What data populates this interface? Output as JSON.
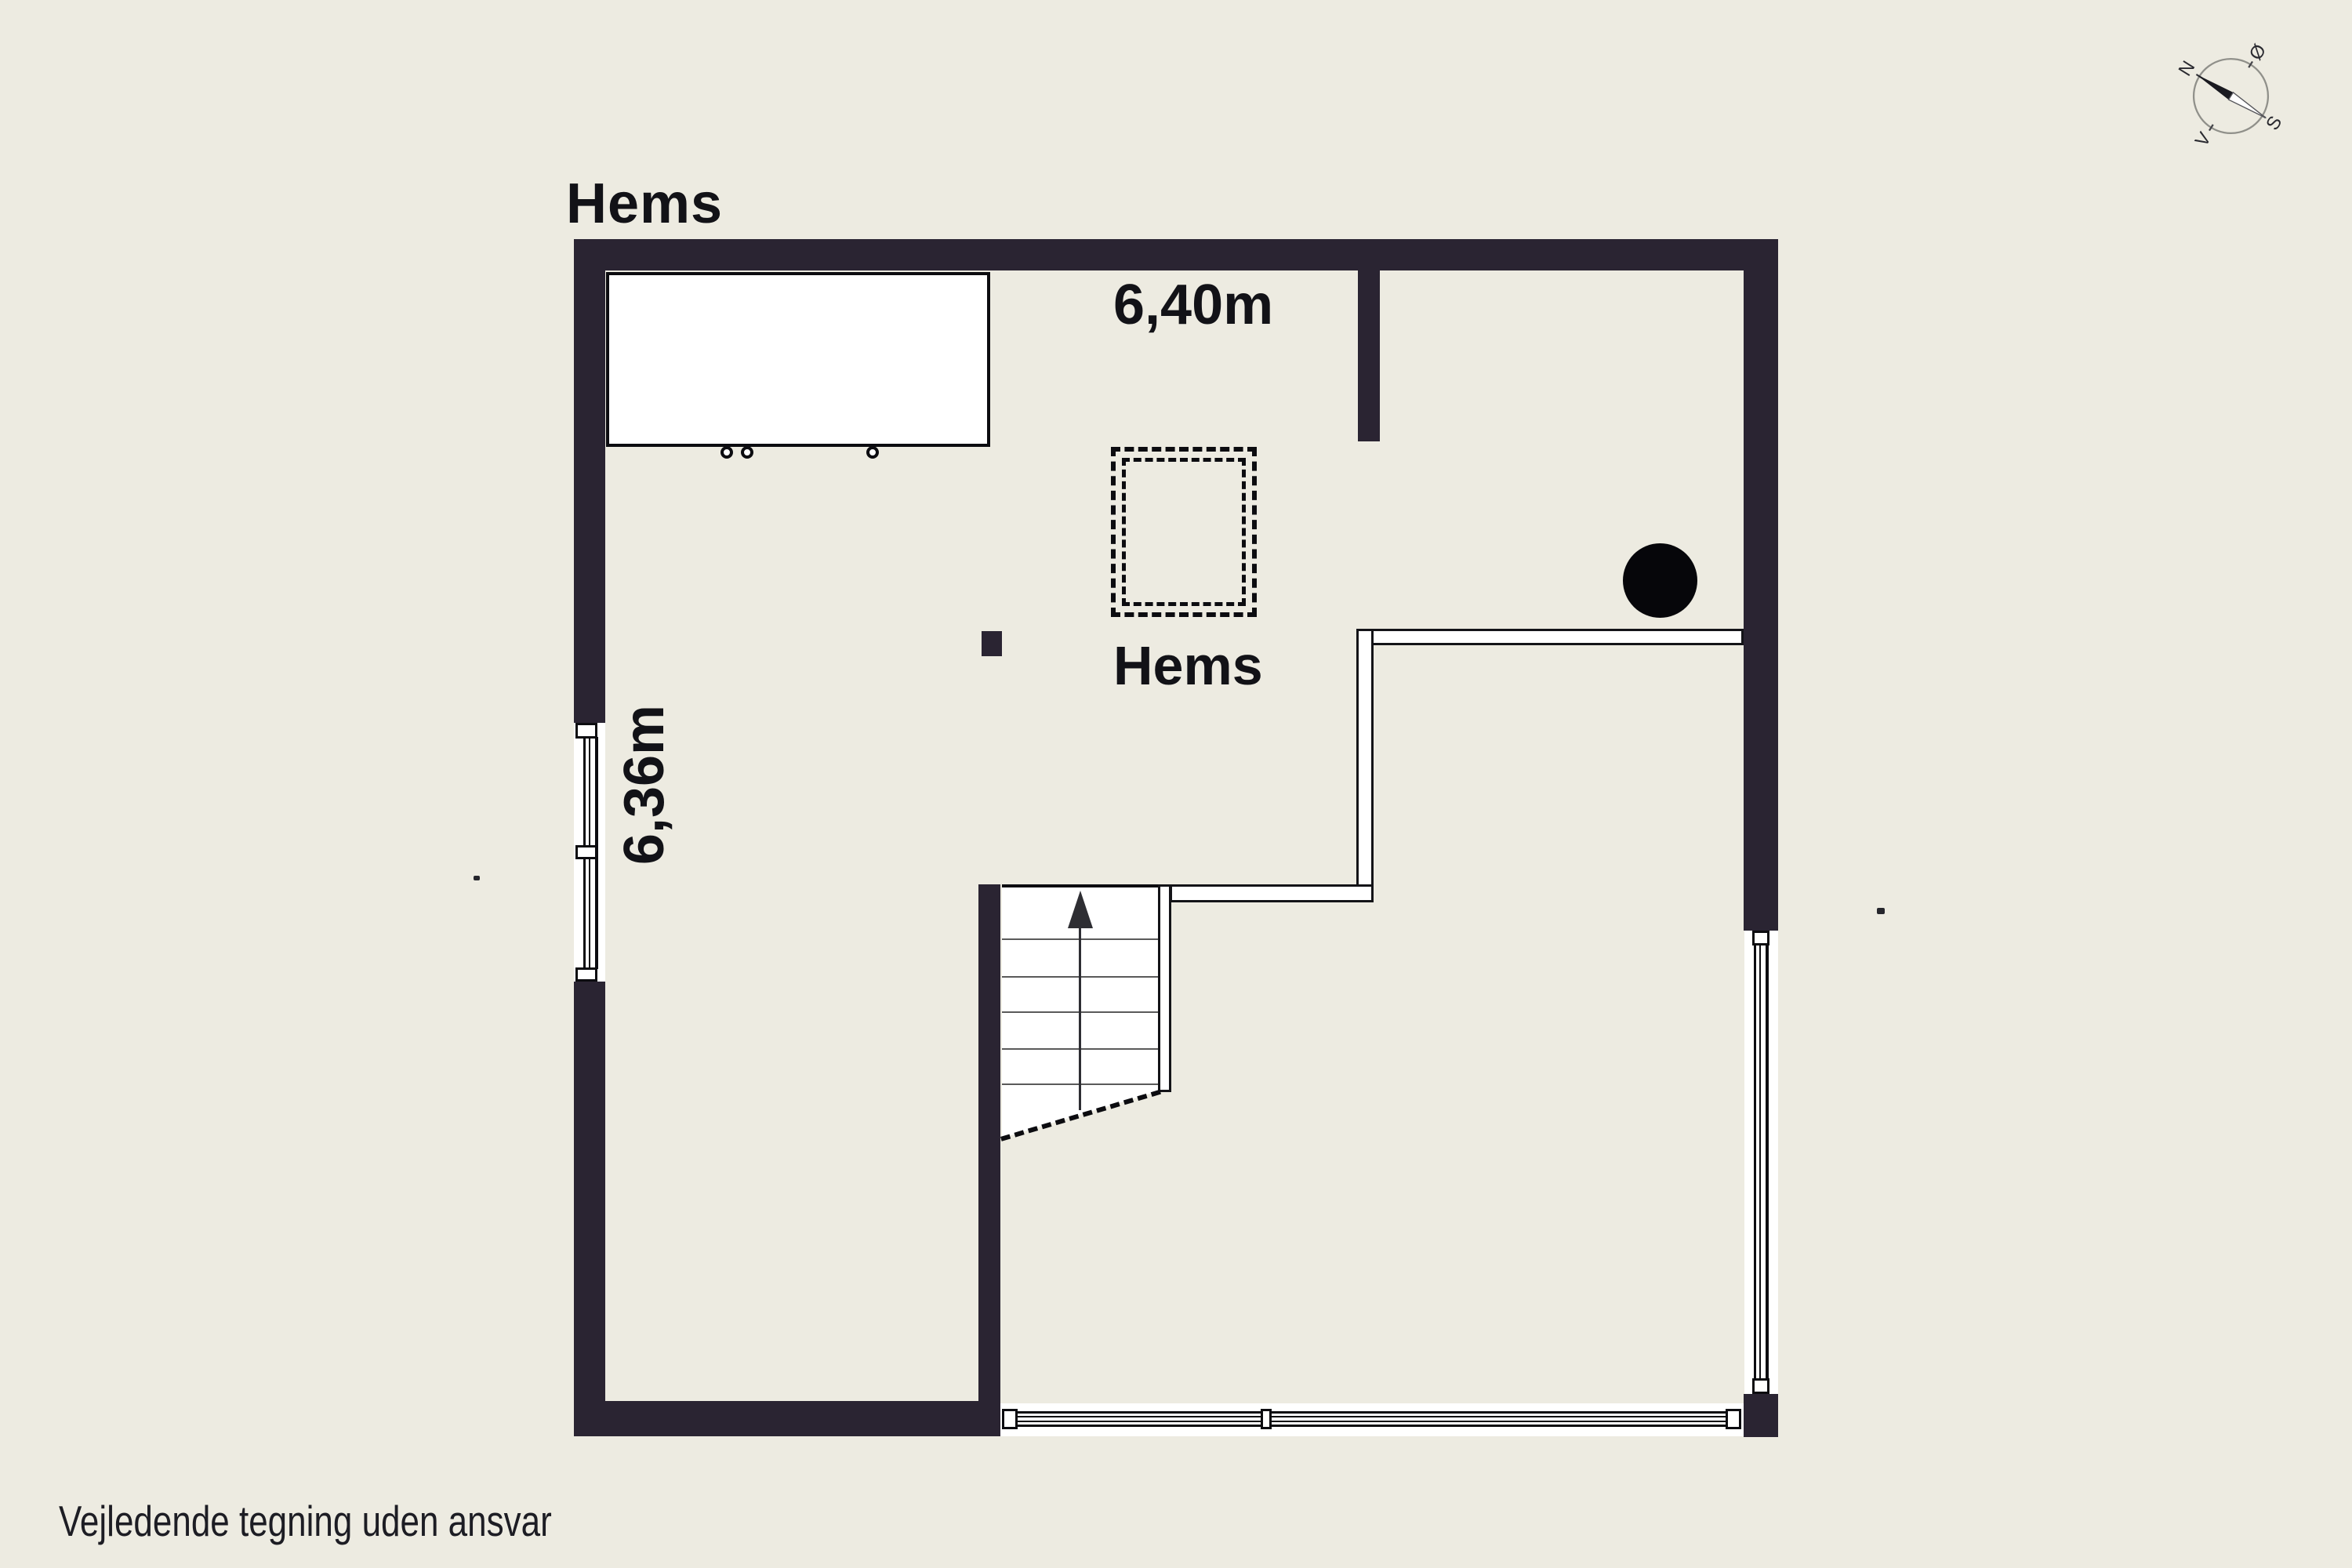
{
  "title": "Hems",
  "labels": {
    "width_dim": "6,40m",
    "height_dim": "6,36m",
    "room": "Hems"
  },
  "disclaimer": "Vejledende tegning uden ansvar",
  "compass": {
    "north": "N",
    "east": "Ø",
    "south": "S",
    "west": "V"
  },
  "colors": {
    "background": "#edebe1",
    "wall": "#2a2432",
    "outline": "#0c0c10",
    "tread": "#5a5a5a",
    "text": "#121217",
    "stove": "#06060a",
    "white": "#ffffff"
  }
}
